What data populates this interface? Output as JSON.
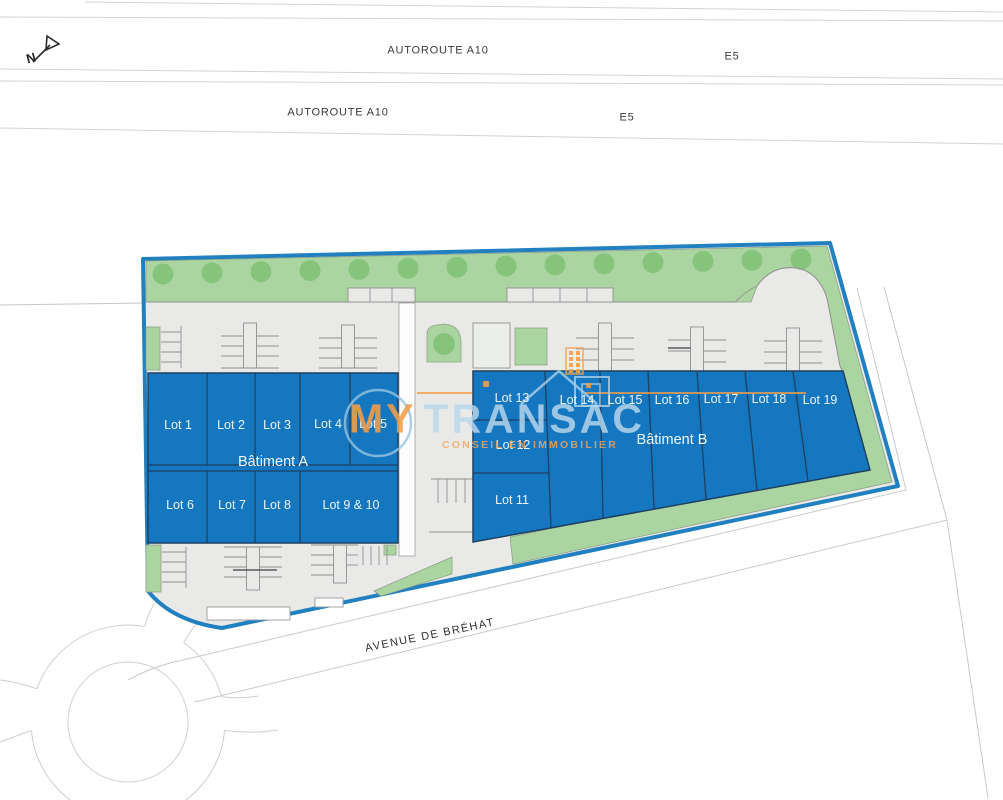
{
  "compass": {
    "letter": "N"
  },
  "roads_top": {
    "band1": {
      "name_label": "AUTOROUTE A10",
      "ref_label": "E5"
    },
    "band2": {
      "name_label": "AUTOROUTE A10",
      "ref_label": "E5"
    }
  },
  "avenue": {
    "label": "AVENUE DE BRÉHAT"
  },
  "site": {
    "batiment_a": {
      "label": "Bâtiment A",
      "lots_top": [
        "Lot 1",
        "Lot 2",
        "Lot 3",
        "Lot 4",
        "Lot 5"
      ],
      "lots_bottom": [
        "Lot 6",
        "Lot 7",
        "Lot 8",
        "Lot 9 & 10"
      ]
    },
    "batiment_b": {
      "label": "Bâtiment B",
      "lots_column": [
        "Lot 13",
        "Lot 12",
        "Lot 11"
      ],
      "lots_top": [
        "Lot 14",
        "Lot 15",
        "Lot 16",
        "Lot 17",
        "Lot 18",
        "Lot 19"
      ]
    }
  },
  "watermark": {
    "brand_primary": "MY",
    "brand_secondary": "TRANSAC",
    "tagline": "CONSEIL EN IMMOBILIER"
  },
  "colors": {
    "lot_fill": "#1677C1",
    "lot_divider": "#1E4061",
    "boundary_blue": "#2180C0",
    "green_band": "#ABD5A0",
    "tree_green": "#86C47B",
    "site_gray": "#E9EAE7",
    "brand_orange": "#F29E49",
    "brand_blue_light": "#AACDE4"
  }
}
